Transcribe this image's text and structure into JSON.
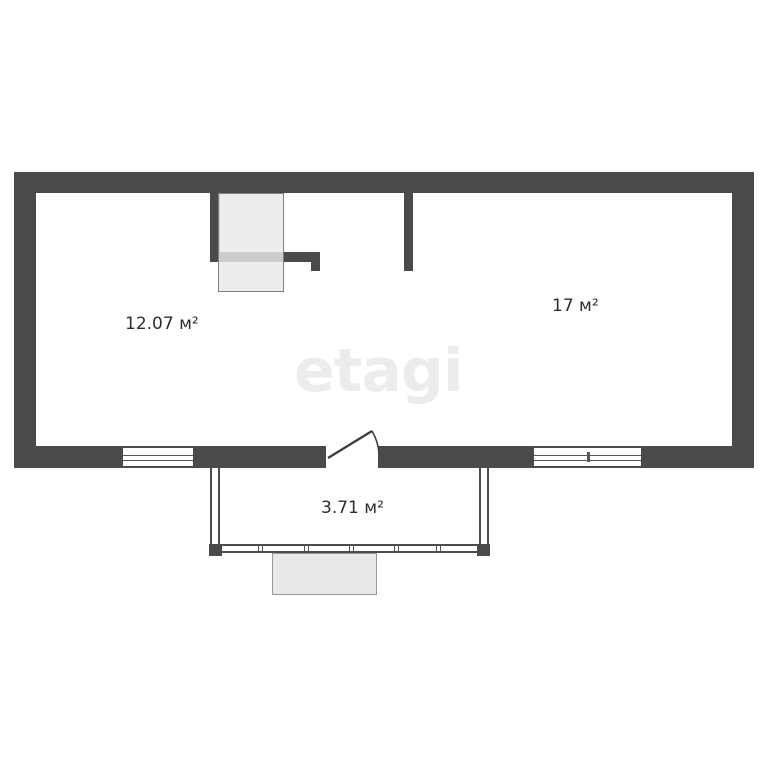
{
  "floorplan": {
    "watermark_text": "etagi",
    "rooms": {
      "left": {
        "area": "12.07 м²"
      },
      "right": {
        "area": "17 м²"
      },
      "balcony": {
        "area": "3.71 м²"
      }
    },
    "colors": {
      "wall": "#4a4a4a",
      "thin_line": "#555555",
      "watermark": "#ececea",
      "label_text": "#2d2d2d",
      "closet_fill": "#e9e9ec",
      "porch_fill": "#e9e9e9",
      "background": "#ffffff"
    }
  }
}
